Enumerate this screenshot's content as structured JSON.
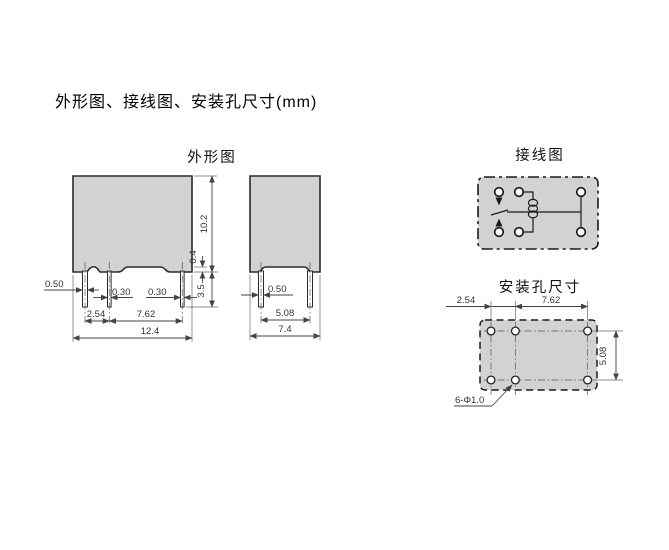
{
  "title": "外形图、接线图、安装孔尺寸(mm)",
  "figures": {
    "outline": {
      "label": "外形图",
      "front": {
        "dims": {
          "pin1_width": "0.50",
          "pin2_width": "0.30",
          "pin3_width": "0.30",
          "pin_spacing_1": "2.54",
          "pin_spacing_2": "7.62",
          "overall_width": "12.4",
          "body_height": "10.2",
          "standoff_height": "0.4",
          "pin_length": "3.5"
        }
      },
      "side": {
        "dims": {
          "pin_width": "0.50",
          "pin_spacing": "5.08",
          "overall_depth": "7.4"
        }
      }
    },
    "wiring": {
      "label": "接线图"
    },
    "mounting": {
      "label": "安装孔尺寸",
      "dims": {
        "col_spacing_1": "2.54",
        "col_spacing_2": "7.62",
        "row_spacing": "5.08",
        "hole_note": "6-Φ1.0"
      }
    }
  },
  "colors": {
    "body_fill": "#d2d2d2",
    "line": "#2a2a2a",
    "dim_line": "#444444"
  }
}
